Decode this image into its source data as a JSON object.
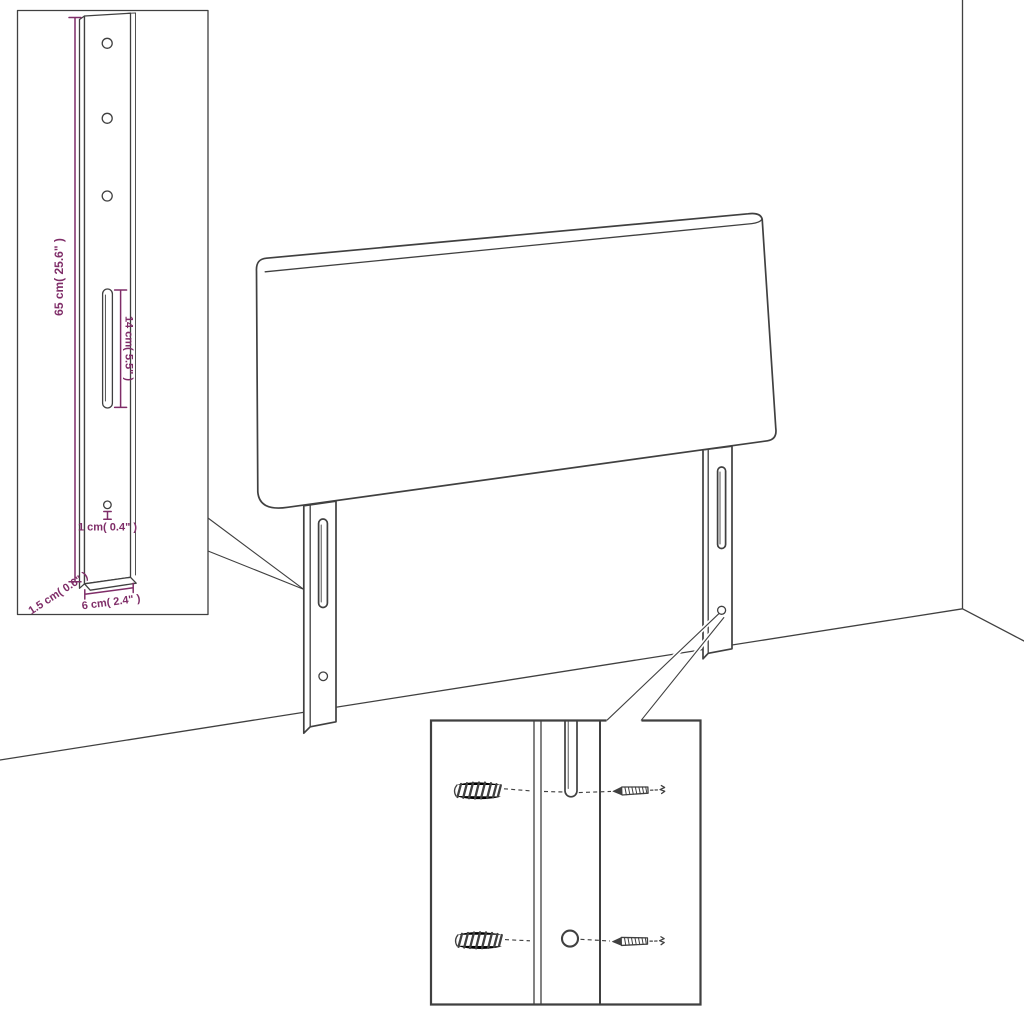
{
  "colors": {
    "background": "#ffffff",
    "line": "#404040",
    "accent": "#7f2d68"
  },
  "dimension_labels": {
    "bracket_height": "65 cm( 25.6\" )",
    "slot_length": "14 cm( 5.5\" )",
    "hole_diameter": "1 cm( 0.4\" )",
    "bracket_thickness": "1.5 cm( 0.6\" )",
    "bracket_width": "6 cm( 2.4\" )"
  },
  "icons": {
    "wall_plug": "wall-plug-icon",
    "screw": "screw-icon"
  },
  "scene": {
    "subject": "headboard with two mounting legs shown against a room corner",
    "insets": [
      "leg-dimension-detail",
      "wall-mounting-hardware-detail"
    ]
  }
}
